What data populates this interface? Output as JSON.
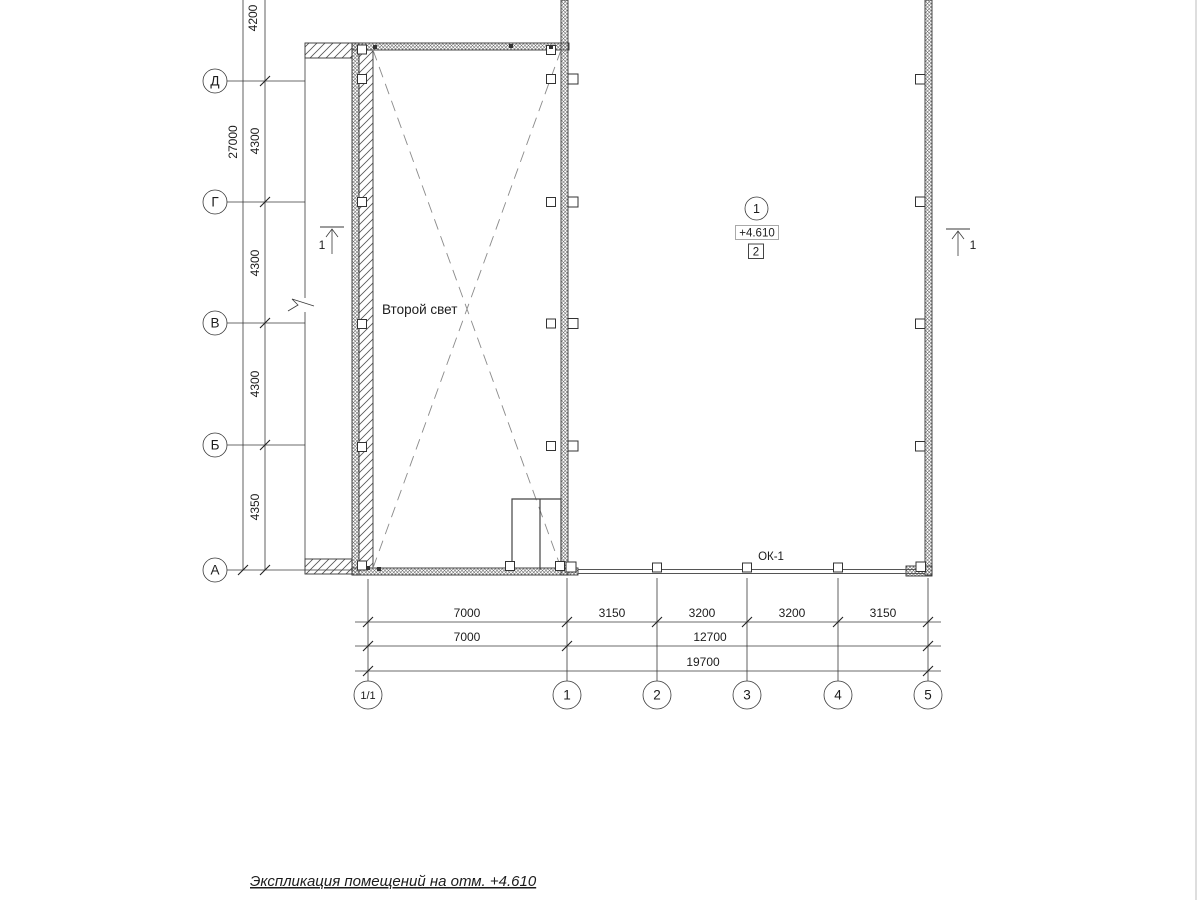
{
  "title": {
    "text": "Экспликация помещений на отм. +4.610"
  },
  "labels": {
    "room": "Второй свет",
    "window": "ОК-1",
    "space_number": "1",
    "level_mark": "+4.610",
    "room_type": "2",
    "section_left": "1",
    "section_right": "1"
  },
  "axes": {
    "rows": [
      {
        "label": "Д"
      },
      {
        "label": "Г"
      },
      {
        "label": "В"
      },
      {
        "label": "Б"
      },
      {
        "label": "А"
      }
    ],
    "cols": [
      {
        "label": "1/1"
      },
      {
        "label": "1"
      },
      {
        "label": "2"
      },
      {
        "label": "3"
      },
      {
        "label": "4"
      },
      {
        "label": "5"
      }
    ]
  },
  "dimensions": {
    "left_segments": [
      "4200",
      "4300",
      "4300",
      "4300",
      "4350"
    ],
    "left_total": "27000",
    "bottom_row1": [
      "7000",
      "3150",
      "3200",
      "3200",
      "3150"
    ],
    "bottom_row2": [
      "7000",
      "12700"
    ],
    "bottom_row3": [
      "19700"
    ]
  },
  "colors": {
    "line": "#3a3a3a",
    "hatch": "#555555",
    "dashed_cross": "#8a8a8a",
    "frame": "#c8c8c8"
  }
}
